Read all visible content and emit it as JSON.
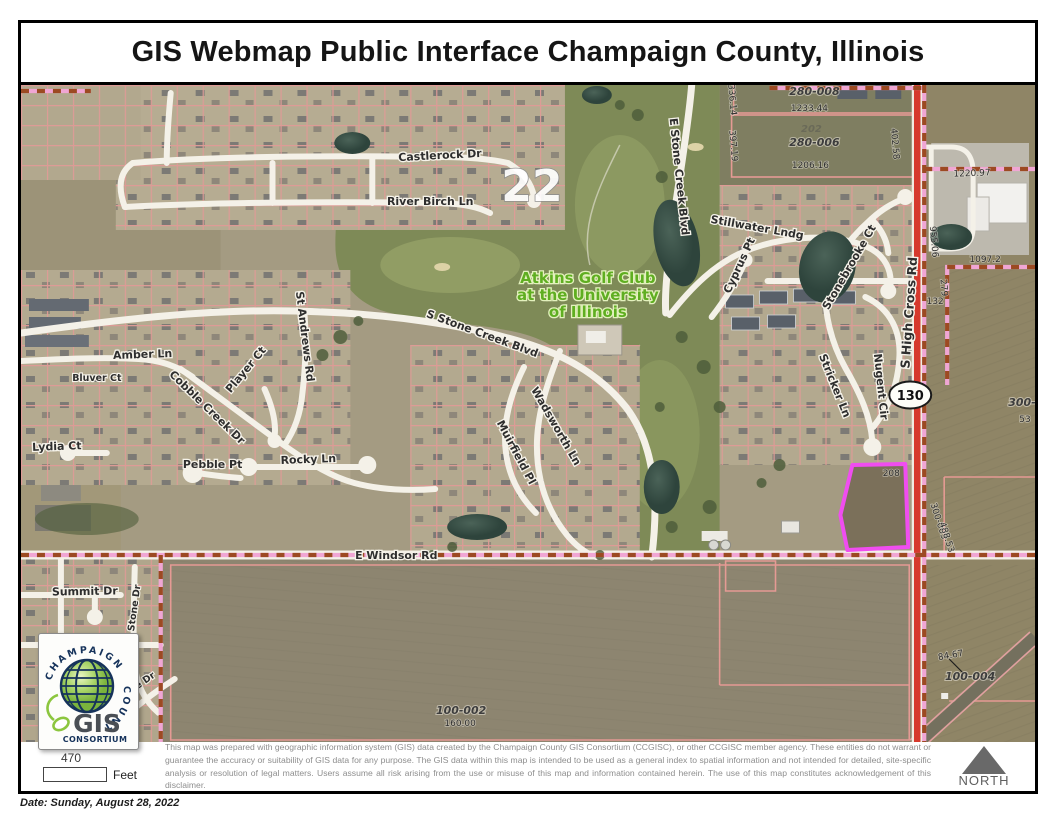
{
  "page": {
    "title": "GIS Webmap Public Interface Champaign County, Illinois",
    "date_line": "Date: Sunday, August 28, 2022"
  },
  "footer": {
    "scale_value": "470",
    "scale_unit": "Feet",
    "north_label": "NORTH",
    "disclaimer": "This map was prepared with geographic information system (GIS) data created by the Champaign County GIS Consortium (CCGISC), or other CCGISC member agency. These entities do not warrant or guarantee the accuracy or suitability of GIS data for any purpose. The GIS data within this map is intended to be used as a general index to spatial information and not intended for detailed, site-specific analysis or resolution of legal matters. Users assume all risk arising from the use or misuse of this map and information contained herein. The use of this map constitutes acknowledgement of this disclaimer."
  },
  "logo": {
    "arc_top": "CHAMPAIGN",
    "arc_right": "COUNTY",
    "name": "GIS",
    "subname": "CONSORTIUM"
  },
  "map": {
    "highlight_color": "#f04df0",
    "route_shield": "130",
    "section_number": "22",
    "labels": [
      {
        "text": "Castlerock Dr",
        "x": 420,
        "y": 74,
        "rot": -3,
        "cls": "street"
      },
      {
        "text": "River Birch Ln",
        "x": 410,
        "y": 120,
        "rot": 0,
        "cls": "street"
      },
      {
        "text": "E Stone Creek Blvd",
        "x": 656,
        "y": 92,
        "rot": 84,
        "cls": "street"
      },
      {
        "text": "Stillwater Lndg",
        "x": 737,
        "y": 146,
        "rot": 10,
        "cls": "street"
      },
      {
        "text": "Cyprus Pt",
        "x": 723,
        "y": 182,
        "rot": -65,
        "cls": "street"
      },
      {
        "text": "Stonebrooke Ct",
        "x": 833,
        "y": 184,
        "rot": -60,
        "cls": "street"
      },
      {
        "text": "S High Cross Rd",
        "x": 894,
        "y": 228,
        "rot": -86,
        "cls": "street-lg"
      },
      {
        "text": "Stricker Ln",
        "x": 812,
        "y": 302,
        "rot": 68,
        "cls": "street"
      },
      {
        "text": "Nugent Cir",
        "x": 858,
        "y": 302,
        "rot": 84,
        "cls": "street"
      },
      {
        "text": "Amber Ln",
        "x": 122,
        "y": 273,
        "rot": -2,
        "cls": "street"
      },
      {
        "text": "Bluver Ct",
        "x": 76,
        "y": 296,
        "rot": 0,
        "cls": "street-sm"
      },
      {
        "text": "St Andrews Rd",
        "x": 281,
        "y": 252,
        "rot": 83,
        "cls": "street"
      },
      {
        "text": "Player Ct",
        "x": 228,
        "y": 287,
        "rot": -50,
        "cls": "street"
      },
      {
        "text": "Cobble Creek Dr",
        "x": 184,
        "y": 325,
        "rot": 44,
        "cls": "street"
      },
      {
        "text": "S Stone Creek Blvd",
        "x": 461,
        "y": 252,
        "rot": 20,
        "cls": "street"
      },
      {
        "text": "Lydia Ct",
        "x": 36,
        "y": 365,
        "rot": -2,
        "cls": "street"
      },
      {
        "text": "Pebble Pt",
        "x": 192,
        "y": 383,
        "rot": 0,
        "cls": "street"
      },
      {
        "text": "Rocky Ln",
        "x": 288,
        "y": 378,
        "rot": -2,
        "cls": "street"
      },
      {
        "text": "Wadsworth Ln",
        "x": 533,
        "y": 343,
        "rot": 60,
        "cls": "street"
      },
      {
        "text": "Muirfield Pl",
        "x": 493,
        "y": 369,
        "rot": 62,
        "cls": "street"
      },
      {
        "text": "E Windsor Rd",
        "x": 376,
        "y": 474,
        "rot": 0,
        "cls": "street"
      },
      {
        "text": "Summit Dr",
        "x": 64,
        "y": 510,
        "rot": -1,
        "cls": "street"
      },
      {
        "text": "Susan Stone Dr",
        "x": 114,
        "y": 541,
        "rot": -82,
        "cls": "street-sm"
      },
      {
        "text": "ge Dr",
        "x": 123,
        "y": 600,
        "rot": -35,
        "cls": "street-sm"
      },
      {
        "text": "Atkins Golf Club",
        "x": 568,
        "y": 198,
        "rot": 0,
        "cls": "golf"
      },
      {
        "text": "at the University",
        "x": 568,
        "y": 215,
        "rot": 0,
        "cls": "golf"
      },
      {
        "text": "of Illinois",
        "x": 568,
        "y": 232,
        "rot": 0,
        "cls": "golf"
      },
      {
        "text": "280-008",
        "x": 795,
        "y": 10,
        "rot": 0,
        "cls": "pid"
      },
      {
        "text": "202",
        "x": 792,
        "y": 47,
        "rot": 0,
        "cls": "pid-faint"
      },
      {
        "text": "280-006",
        "x": 795,
        "y": 61,
        "rot": 0,
        "cls": "pid"
      },
      {
        "text": "100-002",
        "x": 441,
        "y": 629,
        "rot": 0,
        "cls": "pid"
      },
      {
        "text": "100-004",
        "x": 951,
        "y": 595,
        "rot": 0,
        "cls": "pid"
      },
      {
        "text": "300-",
        "x": 1003,
        "y": 321,
        "rot": 0,
        "cls": "pid"
      },
      {
        "text": "300-003",
        "x": 917,
        "y": 437,
        "rot": 72,
        "cls": "dim"
      },
      {
        "text": "1233.44",
        "x": 790,
        "y": 26,
        "rot": 0,
        "cls": "dim"
      },
      {
        "text": "336.14",
        "x": 710,
        "y": 15,
        "rot": 85,
        "cls": "dim"
      },
      {
        "text": "397.19",
        "x": 711,
        "y": 61,
        "rot": 85,
        "cls": "dim"
      },
      {
        "text": "1206.16",
        "x": 791,
        "y": 83,
        "rot": 0,
        "cls": "dim"
      },
      {
        "text": "402.58",
        "x": 873,
        "y": 59,
        "rot": 85,
        "cls": "dim"
      },
      {
        "text": "1220.97",
        "x": 953,
        "y": 91,
        "rot": -2,
        "cls": "dim"
      },
      {
        "text": "955.06",
        "x": 912,
        "y": 157,
        "rot": 85,
        "cls": "dim"
      },
      {
        "text": "1097.2",
        "x": 966,
        "y": 177,
        "rot": 0,
        "cls": "dim"
      },
      {
        "text": "279",
        "x": 922,
        "y": 203,
        "rot": 85,
        "cls": "dim"
      },
      {
        "text": "132",
        "x": 916,
        "y": 219,
        "rot": 0,
        "cls": "dim"
      },
      {
        "text": "208",
        "x": 872,
        "y": 391,
        "rot": 0,
        "cls": "dim"
      },
      {
        "text": "488.53",
        "x": 925,
        "y": 453,
        "rot": 72,
        "cls": "dim"
      },
      {
        "text": "53",
        "x": 1006,
        "y": 337,
        "rot": 0,
        "cls": "dim"
      },
      {
        "text": "160.00",
        "x": 440,
        "y": 641,
        "rot": 0,
        "cls": "dim"
      },
      {
        "text": "84.67",
        "x": 932,
        "y": 573,
        "rot": -10,
        "cls": "dim"
      }
    ]
  }
}
